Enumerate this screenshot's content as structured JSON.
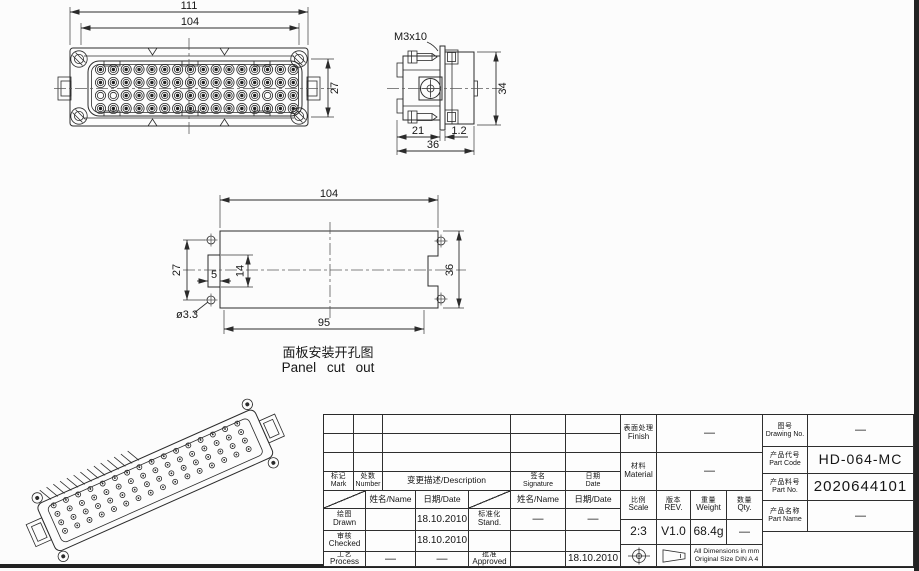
{
  "front_view": {
    "dim_overall_width": "111",
    "dim_inner_width": "104",
    "dim_pin_height": "27"
  },
  "side_view": {
    "screw_label": "M3x10",
    "dim_height": "34",
    "dim_front_depth": "21",
    "dim_flange": "1.2",
    "dim_total_depth": "36"
  },
  "panel_cutout": {
    "dim_width_top": "104",
    "dim_width_bottom": "95",
    "dim_hole_spacing": "27",
    "dim_tab_height": "14",
    "dim_tab_depth": "5",
    "dim_height": "36",
    "dim_hole": "ø3.3",
    "caption_zh": "面板安装开孔图",
    "caption_en": "Panel cut out"
  },
  "title_block": {
    "mark_zh": "标记",
    "mark_en": "Mark",
    "number_zh": "处数",
    "number_en": "Number",
    "desc": "变更描述/Description",
    "sig_zh": "签名",
    "sig_en": "Signature",
    "date_zh": "日期",
    "date_en": "Date",
    "name_hdr": "姓名/Name",
    "date_hdr": "日期/Date",
    "drawn_zh": "绘图",
    "drawn_en": "Drawn",
    "drawn_name": "",
    "drawn_date": "18.10.2010",
    "stand_zh": "标准化",
    "stand_en": "Stand.",
    "stand_name": "—",
    "stand_date": "—",
    "checked_zh": "审核",
    "checked_en": "Checked",
    "checked_name": "",
    "checked_date": "18.10.2010",
    "process_zh": "工艺",
    "process_en": "Process",
    "process_name": "—",
    "process_date": "—",
    "approved_zh": "批准",
    "approved_en": "Approved",
    "approved_name": "",
    "approved_date": "18.10.2010",
    "finish_zh": "表面处理",
    "finish_en": "Finish",
    "finish_val": "—",
    "material_zh": "材料",
    "material_en": "Material",
    "material_val": "—",
    "scale_zh": "比例",
    "scale_en": "Scale",
    "scale_val": "2:3",
    "rev_zh": "版本",
    "rev_en": "REV.",
    "rev_val": "V1.0",
    "weight_zh": "重量",
    "weight_en": "Weight",
    "weight_val": "68.4g",
    "qty_zh": "数量",
    "qty_en": "Qty.",
    "qty_val": "—",
    "drawing_no_zh": "图号",
    "drawing_no_en": "Drawing No.",
    "drawing_no_val": "—",
    "part_code_zh": "产品代号",
    "part_code_en": "Part Code",
    "part_code_val": "HD-064-MC",
    "part_no_zh": "产品料号",
    "part_no_en": "Part No.",
    "part_no_val": "2020644101",
    "part_name_zh": "产品名称",
    "part_name_en": "Part Name",
    "part_name_val": "—",
    "note_line1": "All Dimensions in mm",
    "note_line2": "Original Size DIN A 4"
  },
  "colors": {
    "line": "#2b2b2b",
    "frame": "#222222",
    "paper": "#fcfcfc"
  }
}
